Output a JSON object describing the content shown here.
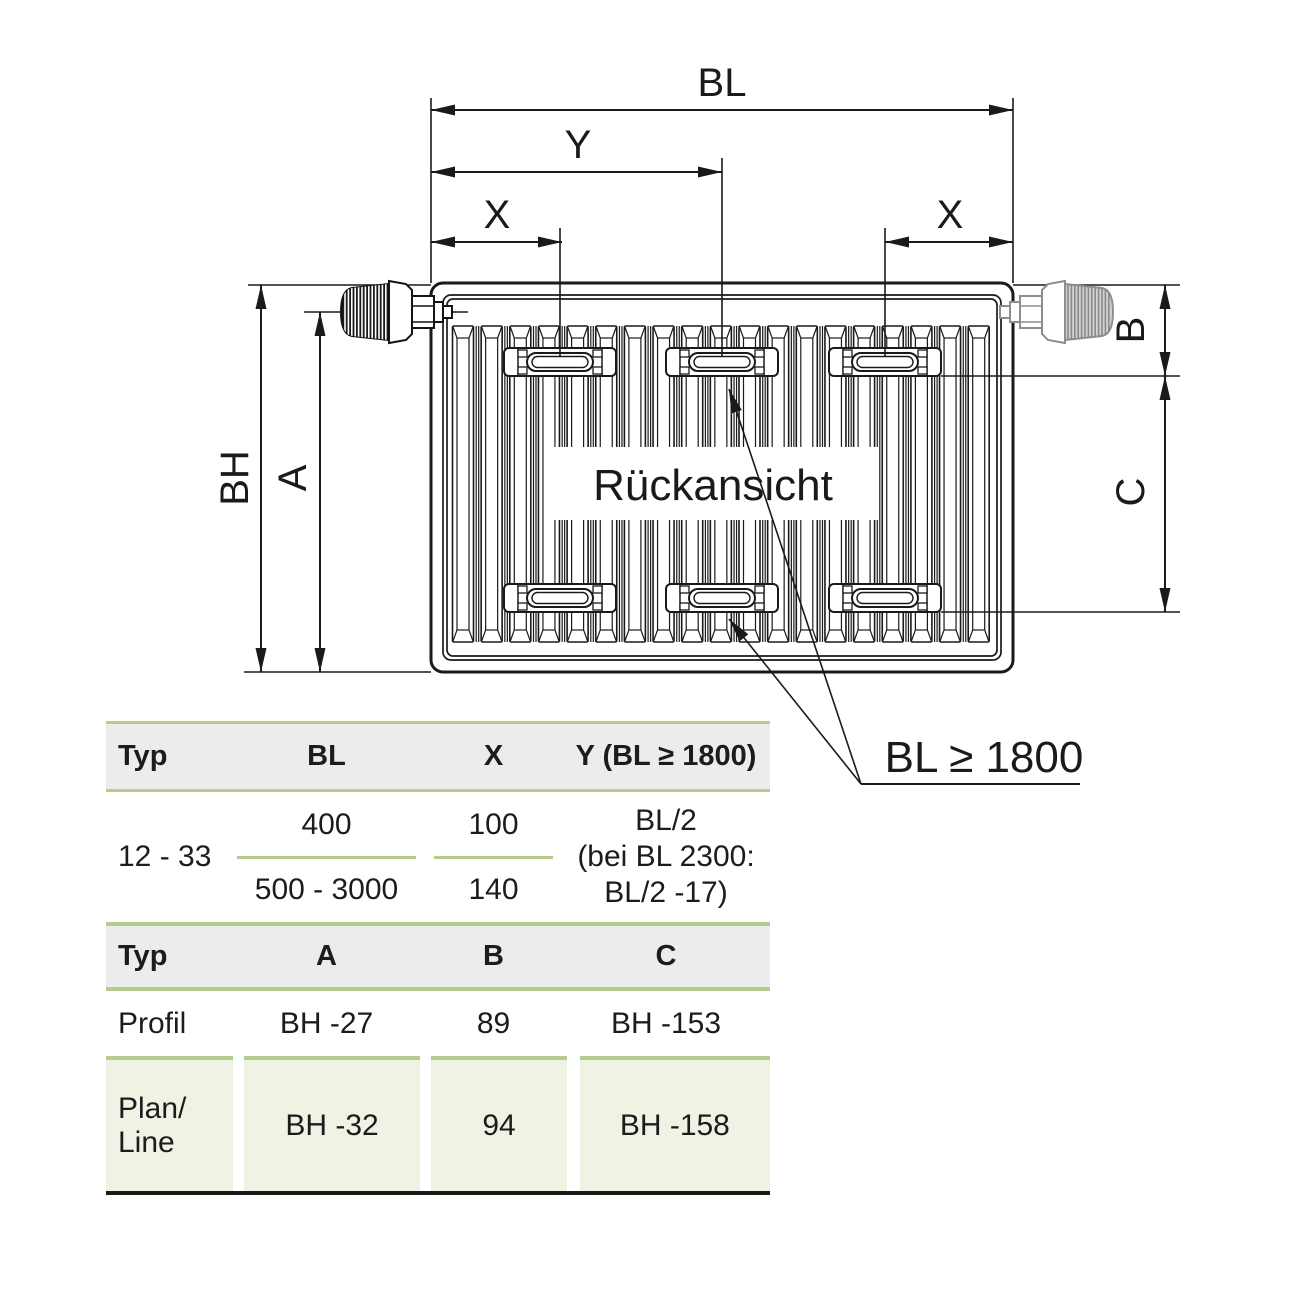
{
  "drawing": {
    "view_label": "Rückansicht",
    "bracket_note": "BL ≥ 1800",
    "dim_labels": {
      "bl": "BL",
      "y": "Y",
      "x_left": "X",
      "x_right": "X",
      "bh": "BH",
      "a": "A",
      "b": "B",
      "c": "C"
    }
  },
  "tables": {
    "placement": {
      "headers": [
        "Typ",
        "BL",
        "X",
        "Y (BL ≥ 1800)"
      ],
      "row": {
        "typ": "12 - 33",
        "bl_top": "400",
        "bl_bottom": "500 - 3000",
        "x_top": "100",
        "x_bottom": "140",
        "y_lines": [
          "BL/2",
          "(bei BL 2300:",
          "BL/2 -17)"
        ]
      }
    },
    "abc": {
      "headers": [
        "Typ",
        "A",
        "B",
        "C"
      ],
      "rows": [
        {
          "typ": "Profil",
          "a": "BH -27",
          "b": "89",
          "c": "BH -153"
        },
        {
          "typ_line1": "Plan/",
          "typ_line2": "Line",
          "a": "BH -32",
          "b": "94",
          "c": "BH -158"
        }
      ]
    }
  },
  "colors": {
    "ink": "#1a1a1a",
    "table_line_green": "#b4cc8e",
    "header_gray": "#ececec",
    "row_tint_green": "#eef3e4",
    "valve_gray": "#8e8e8e"
  }
}
